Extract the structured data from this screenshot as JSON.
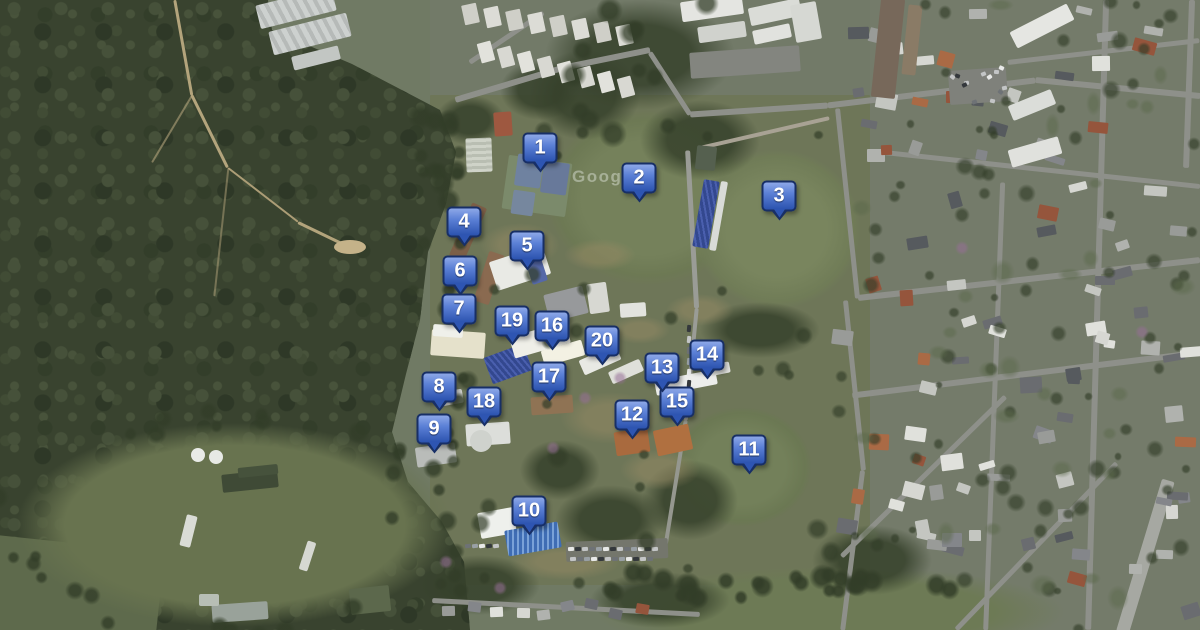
{
  "map": {
    "type": "satellite-imagery",
    "provider_watermark": "Google",
    "marker_count": 20,
    "marker_style": {
      "fill_top": "#8aa4e6",
      "fill_bottom": "#2b52ae",
      "border": "#182f66",
      "text_color": "#ffffff"
    },
    "markers": [
      {
        "label": "1",
        "x": 540,
        "y": 148
      },
      {
        "label": "2",
        "x": 639,
        "y": 178
      },
      {
        "label": "3",
        "x": 779,
        "y": 196
      },
      {
        "label": "4",
        "x": 464,
        "y": 222
      },
      {
        "label": "5",
        "x": 527,
        "y": 246
      },
      {
        "label": "6",
        "x": 460,
        "y": 271
      },
      {
        "label": "7",
        "x": 459,
        "y": 309
      },
      {
        "label": "8",
        "x": 439,
        "y": 387
      },
      {
        "label": "9",
        "x": 434,
        "y": 429
      },
      {
        "label": "10",
        "x": 529,
        "y": 511
      },
      {
        "label": "11",
        "x": 749,
        "y": 450
      },
      {
        "label": "12",
        "x": 632,
        "y": 415
      },
      {
        "label": "13",
        "x": 662,
        "y": 368
      },
      {
        "label": "14",
        "x": 707,
        "y": 355
      },
      {
        "label": "15",
        "x": 677,
        "y": 402
      },
      {
        "label": "16",
        "x": 552,
        "y": 326
      },
      {
        "label": "17",
        "x": 549,
        "y": 377
      },
      {
        "label": "18",
        "x": 484,
        "y": 402
      },
      {
        "label": "19",
        "x": 512,
        "y": 321
      },
      {
        "label": "20",
        "x": 602,
        "y": 341
      }
    ]
  }
}
